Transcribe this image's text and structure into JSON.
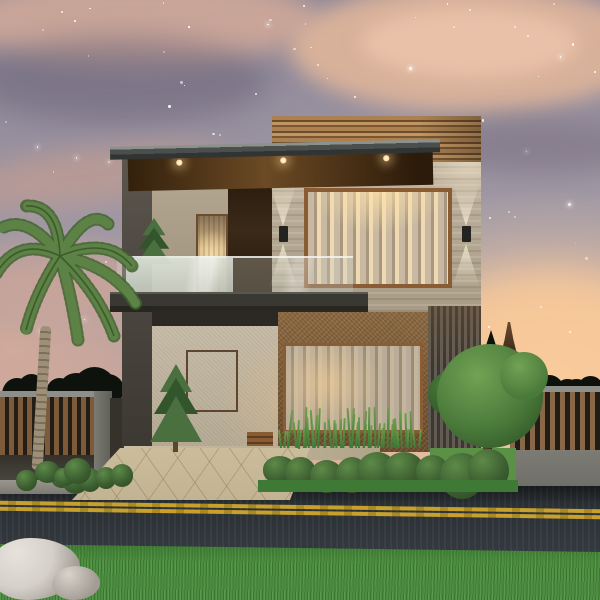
{
  "meta": {
    "subject": "modern two-storey house exterior at dusk",
    "kind": "architectural 3d render, front elevation, starry evening sky"
  },
  "palette": {
    "skyTop": "#8b8598",
    "skyMid": "#a29aa5",
    "skyPink": "#c7a59c",
    "skyWarm": "#eec19e",
    "skyGlow": "#f6cfa6",
    "cloudSalmon": "#d8b19a",
    "cloudBright": "#e9c0a8",
    "star": "#ffffff",
    "parapetWood": "#ab8152",
    "parapetDark": "#6e4c2a",
    "soffitLight": "#6b4a24",
    "lightWarm": "#ffd9a0",
    "travertine": "#c2b5a1",
    "travertineDark": "#a89b85",
    "travertineShade": "#b2a590",
    "woodFrame": "#8a5c33",
    "recessWood": "#3b2a18",
    "curtain": "#c9b9a2",
    "curtainLit": "#efd9b2",
    "curtainDim": "#a8977f",
    "sheer": "#b9ac98",
    "canopySlab": "#393833",
    "stucco": "#c7bca8",
    "cork": "#8d6a42",
    "corkDark": "#6b4e2d",
    "sidingDark": "#3b3732",
    "sideWall": "#4f4a43",
    "porchCeiling": "#2c2924",
    "porchFloor": "#c9bda4",
    "drive": "#c2b392",
    "fenceWoodL": "#7d5b39",
    "fenceWoodR": "#8a6847",
    "fenceDark": "#221d17",
    "fenceCap": "#8f8f89",
    "pillarGray": "#7b7b73",
    "baseWall": "#6f6f69",
    "hedge": "#0e120c",
    "treeLight": "#72a254",
    "tree": "#4a7a3a",
    "treeDark": "#2d5226",
    "spruce": "#4a7040",
    "spruceDark": "#33552c",
    "shrubHi": "#5d8a48",
    "shrub": "#3d5f31",
    "shrubDark": "#2a4521",
    "lawn": "#5a9146",
    "grassStrip": "#3e7a36",
    "grassBlade": "#6f9e4c",
    "road": "#262b2f",
    "roadLight": "#343a40",
    "lineYellow": "#c7a02e",
    "grass": "#4d8f40",
    "grassDark": "#3a7a30",
    "rock": "#d5d0c9",
    "rockShade": "#98928b",
    "palmTrunk": "#9e9078",
    "palmRing": "#7c6f59",
    "palmLeaf": "#5d8246",
    "palmLeafDark": "#41632f"
  },
  "generate": {
    "stars": {
      "count": 96,
      "seed": 42,
      "maxY": 340
    },
    "hedgeLeft": {
      "count": 6,
      "seed": 7,
      "rMin": 26,
      "rMax": 46
    },
    "hedgeRight": {
      "count": 5,
      "seed": 11,
      "rMin": 20,
      "rMax": 34
    },
    "shrubRow": {
      "count": 9,
      "seed": 19,
      "rMin": 30,
      "rMax": 46
    },
    "bushLeft": {
      "count": 5,
      "seed": 23,
      "rMin": 20,
      "rMax": 30
    },
    "palmBaseBush": {
      "count": 4,
      "seed": 29,
      "rMin": 18,
      "rMax": 28
    },
    "windowGrassBlades": {
      "count": 46,
      "seed": 31,
      "hMin": 16,
      "hMax": 42
    }
  }
}
